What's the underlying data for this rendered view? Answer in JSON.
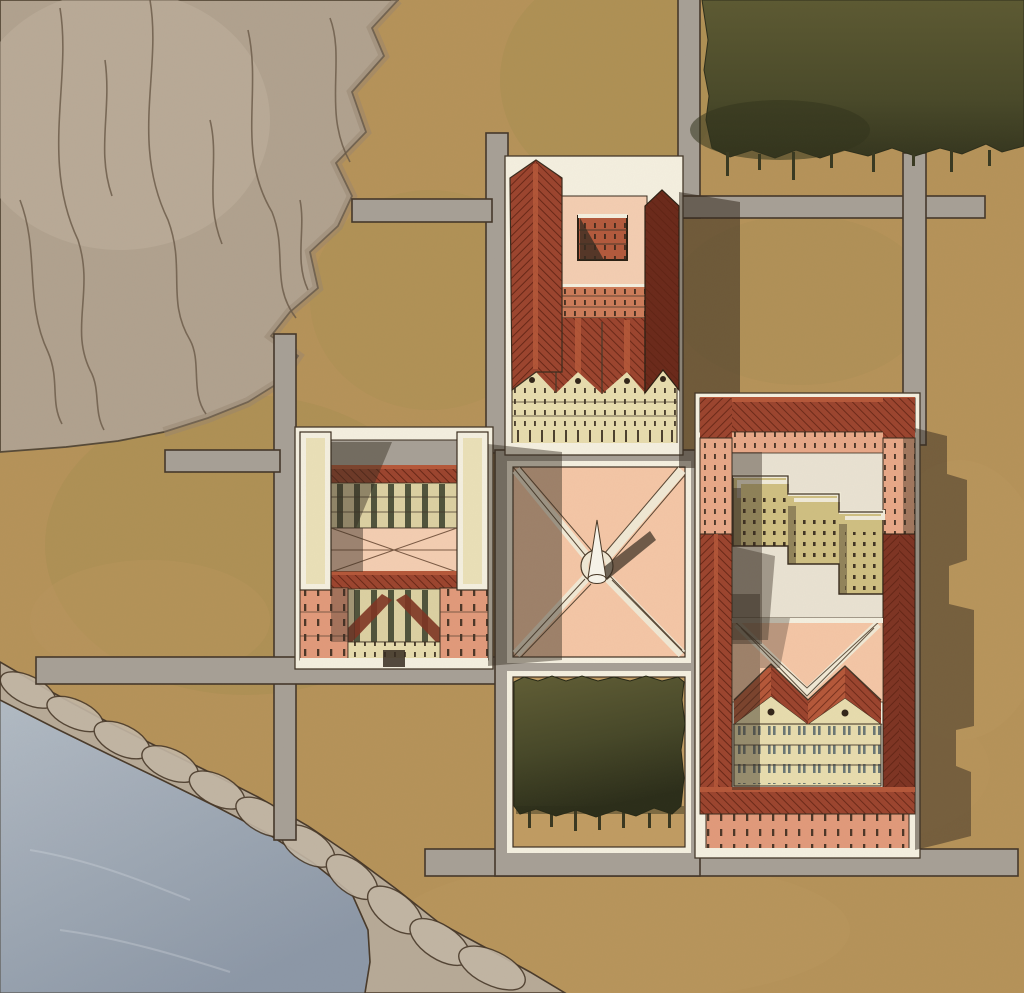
{
  "image": {
    "title": "Watercolor architectural site plan — aerial view of a campus by a lake and rocky hill",
    "width_px": 1024,
    "height_px": 993,
    "style": "hand-painted watercolor masterplan, no text labels"
  },
  "palette": {
    "ground": "#b6935a",
    "ground_olive": "#a28e4f",
    "ground_warm": "#c09c63",
    "road": "#a7a096",
    "road_outline": "#45382a",
    "mountain": "#b1a28f",
    "mountain_shade": "#968672",
    "mountain_line": "#6a5a48",
    "rock": "#b7aa97",
    "rock_light": "#c3b7a5",
    "rock_line": "#4a3b2b",
    "water_light": "#b2bbc4",
    "water_dark": "#8d98a7",
    "trees_light": "#5d5a33",
    "trees_dark": "#35361f",
    "roof_red": "#9c452f",
    "roof_red_lit": "#b5583a",
    "roof_red_dark": "#7e3524",
    "roof_hatch": "#591f10",
    "wing_dark": "#6b2a1b",
    "facade_salmon": "#e19a7b",
    "facade_brick": "#cd7c5a",
    "facade_pink": "#e8a888",
    "facade_cream": "#e7dcae",
    "facade_tan": "#dcd0a2",
    "facade_yellow": "#cfbf82",
    "court_floor": "#e9e2d2",
    "courtyard_pink": "#f3cdb2",
    "plaza_pink": "#f4c6a6",
    "path_cream": "#f0e8d4",
    "white_edge": "#f4efdf",
    "window_dark": "#33261a",
    "window_blue": "#6a7674",
    "colonnade_green": "#51543c",
    "pavilion_brick": "#b35a3d",
    "shadow": "#362c21",
    "obelisk_white": "#f7f4ea"
  },
  "scene": {
    "light": {
      "direction": "from the west (left)",
      "shadows_fall": "east (right)"
    },
    "terrain": [
      {
        "id": "rocky-hill",
        "label": "rocky hillside with contour strokes",
        "position": "top-left quadrant"
      },
      {
        "id": "lake",
        "label": "blue-grey water",
        "position": "bottom-left corner"
      },
      {
        "id": "shoreline-rocks",
        "label": "boulder shoreline band between ground and water",
        "position": "diagonal, lower-left"
      },
      {
        "id": "fields",
        "label": "dry ochre grassland",
        "position": "everywhere else"
      }
    ],
    "vegetation": [
      {
        "id": "tree-grove-top-right",
        "label": "dense dark-olive tree mass with watercolor drips",
        "bounds_px": [
          702,
          0,
          322,
          158
        ]
      },
      {
        "id": "tree-square",
        "label": "square tree bosque inside framed plot below plaza",
        "bounds_px": [
          513,
          676,
          173,
          150
        ]
      }
    ],
    "roads": [
      {
        "id": "north-dead-end",
        "orientation": "vertical",
        "bounds_px": [
          486,
          133,
          22,
          320
        ]
      },
      {
        "id": "hill-stub-north",
        "orientation": "horizontal",
        "bounds_px": [
          352,
          199,
          140,
          23
        ]
      },
      {
        "id": "grove-road",
        "orientation": "vertical",
        "bounds_px": [
          678,
          0,
          22,
          218
        ]
      },
      {
        "id": "east-west-road",
        "orientation": "horizontal",
        "bounds_px": [
          645,
          196,
          340,
          22
        ]
      },
      {
        "id": "east-vertical-road",
        "orientation": "vertical",
        "bounds_px": [
          903,
          153,
          23,
          292
        ]
      },
      {
        "id": "west-vertical-road",
        "orientation": "vertical",
        "bounds_px": [
          274,
          334,
          22,
          506
        ]
      },
      {
        "id": "hill-stub-west",
        "orientation": "horizontal",
        "bounds_px": [
          165,
          450,
          115,
          22
        ]
      },
      {
        "id": "south-road",
        "orientation": "horizontal",
        "bounds_px": [
          36,
          657,
          461,
          27
        ]
      },
      {
        "id": "bottom-road",
        "orientation": "horizontal",
        "bounds_px": [
          425,
          849,
          593,
          27
        ]
      },
      {
        "id": "plaza-frame",
        "orientation": "frame",
        "bounds_px": [
          495,
          450,
          205,
          426
        ]
      }
    ],
    "plaza": {
      "id": "central-plaza",
      "label": "square plaza with diagonal cross paths",
      "paving": "pink with cream X paths meeting at a circle",
      "monument": "white obelisk / cone with shadow cast to the north-east"
    },
    "buildings": [
      {
        "id": "north-building",
        "label": "long courtyard block",
        "features": [
          "red gabled west wing",
          "inner pink court with square pavilion",
          "brick window band",
          "sawtooth red roofs",
          "cream south facade with four gables",
          "dark east wing casting long shadow"
        ]
      },
      {
        "id": "west-building",
        "label": "symmetric terraced block",
        "features": [
          "two white pilaster towers",
          "two red roof strips",
          "green colonnade bands",
          "pink envelope-roof court",
          "salmon corner wings",
          "central entry notch"
        ]
      },
      {
        "id": "east-upper-courtyard",
        "label": "U-shaped court block",
        "features": [
          "red perimeter roofs",
          "pink facades with window ticks",
          "pale-yellow zigzag infill building",
          "cast shadow to east"
        ]
      },
      {
        "id": "east-lower-courtyard",
        "label": "court block with twin houses",
        "features": [
          "red perimeter roofs",
          "pink triangular forecourt with V path",
          "twin gabled cream houses, 3 floors",
          "salmon south facade",
          "cast shadow to east"
        ]
      }
    ]
  }
}
